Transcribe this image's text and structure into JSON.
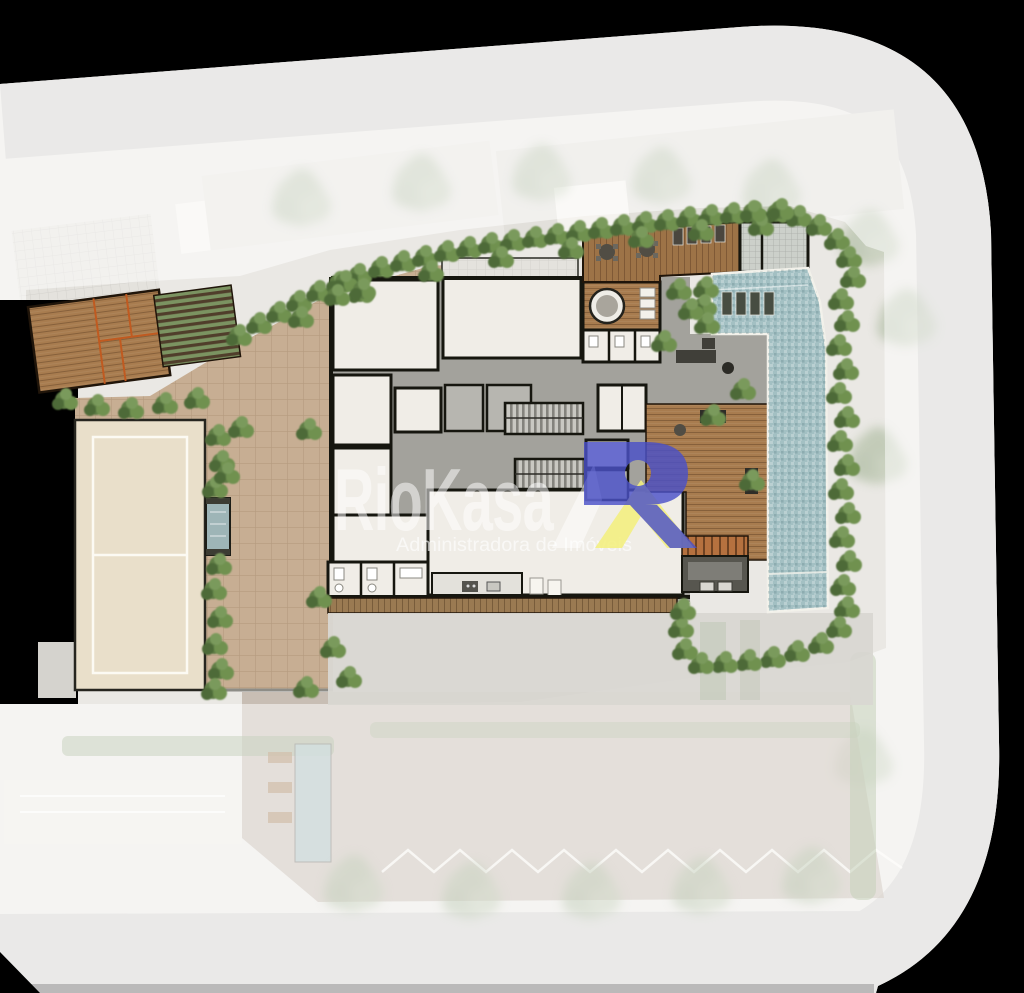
{
  "watermark": {
    "brand": "RioKasa",
    "tagline": "Administradora de Imóveis"
  },
  "colors": {
    "logo_blue": "#4a50c8",
    "logo_yellow": "#f2ef7e",
    "pool": "#a3c0c3",
    "hedge": "#5e7d45",
    "wood_deck": "#a87c4f",
    "paver": "#c7ae93",
    "tennis_court": "#e9dfca",
    "street": "#d4d3d0",
    "sidewalk": "#eae8e4",
    "room": "#f0ede7",
    "wall": "#16160f",
    "corridor": "#a3a29c",
    "stair": "#c9c8c2",
    "background": "#000000"
  }
}
